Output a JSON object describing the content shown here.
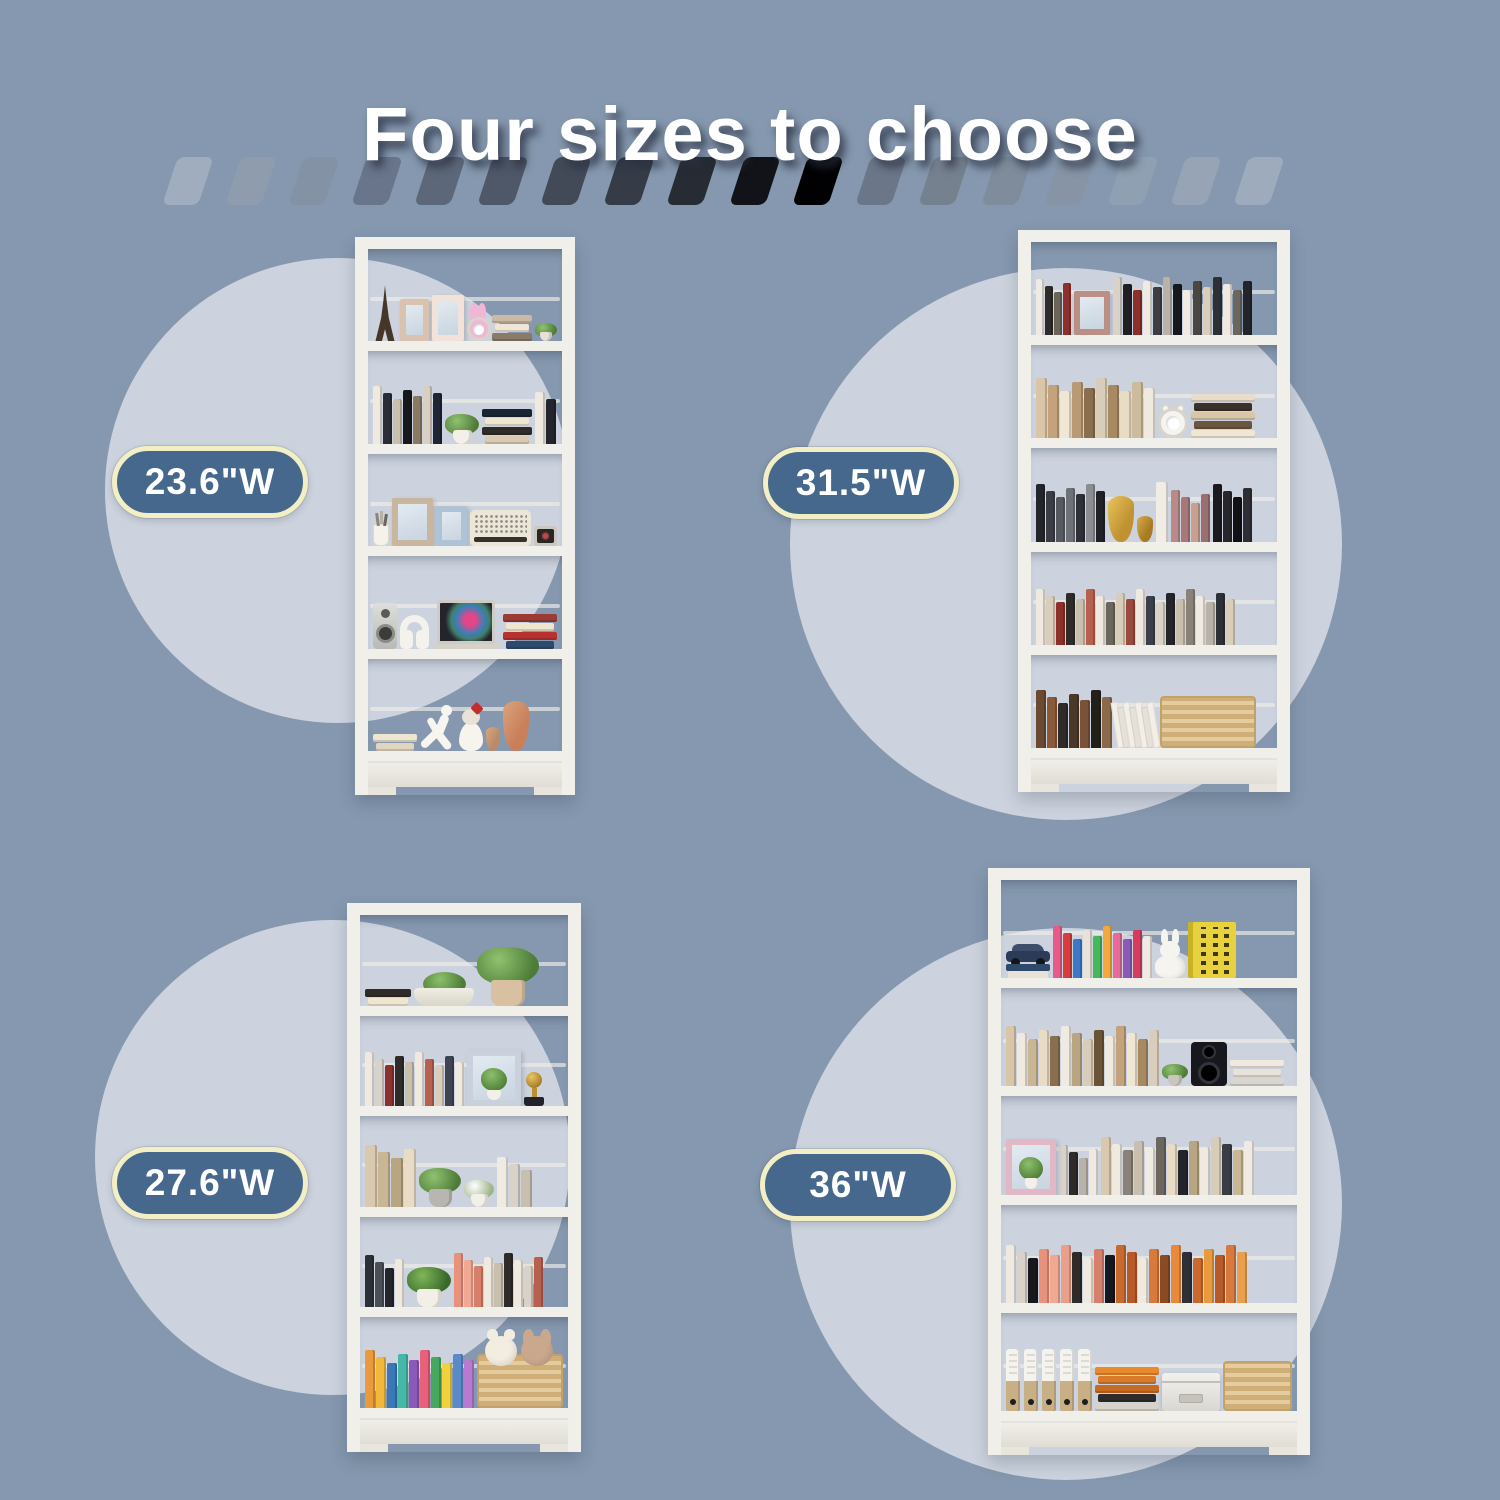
{
  "title": "Four sizes to choose",
  "palette": {
    "background": "#8598AF",
    "circle": "#CCD3DE",
    "pill_fill": "#45688C",
    "pill_border": "#F2EFC4",
    "pill_text": "#FFFFFF",
    "title_color": "#FFFFFF",
    "frame": "#F1EFE9"
  },
  "dashes": [
    "#9fadbe",
    "#8e9cae",
    "#8392a5",
    "#68758a",
    "#5c6879",
    "#4e5868",
    "#424a58",
    "#353c48",
    "#262b34",
    "#111318",
    "#010103",
    "#6b7789",
    "#75818f",
    "#7e8c9b",
    "#8694a6",
    "#8ea0b2",
    "#96a4b6",
    "#9dabbd"
  ],
  "sizes": [
    {
      "id": "tl",
      "label": "23.6\"W"
    },
    {
      "id": "tr",
      "label": "31.5\"W"
    },
    {
      "id": "bl",
      "label": "27.6\"W"
    },
    {
      "id": "br",
      "label": "36\"W"
    }
  ],
  "bookcases": {
    "tl": {
      "shelves": [
        [
          {
            "t": "eiffel",
            "w": 26,
            "h": 56
          },
          {
            "t": "frame",
            "c": "#d9c2ae",
            "w": 30,
            "h": 42
          },
          {
            "t": "frame",
            "c": "#f2e3da",
            "w": 34,
            "h": 46
          },
          {
            "t": "clock",
            "c": "#f0b6d4",
            "kind": "bunny",
            "w": 24,
            "h": 38
          },
          {
            "t": "stack",
            "c": [
              "#c9b9a5",
              "#efe6d8",
              "#8a7a68"
            ],
            "w": 40
          },
          {
            "t": "plant",
            "w": 22,
            "pot": "#e9e1d7"
          }
        ],
        [
          {
            "t": "books",
            "c": [
              "#efe9df",
              "#2a2d35",
              "#c9bfae",
              "#16181d",
              "#8a7a63",
              "#d8cfc2",
              "#1f2535"
            ],
            "h": 58,
            "w": 9
          },
          {
            "t": "plant",
            "w": 34,
            "pot": "#f4f0e9"
          },
          {
            "t": "stack",
            "c": [
              "#1b2433",
              "#efe6d0",
              "#2e2b28",
              "#d9c9b2"
            ],
            "w": 50
          },
          {
            "t": "books",
            "c": [
              "#efe9df",
              "#23252d"
            ],
            "h": 52,
            "w": 10
          }
        ],
        [
          {
            "t": "cup",
            "w": 16,
            "h": 22
          },
          {
            "t": "frame",
            "c": "#c9b6a0",
            "w": 42,
            "h": 48
          },
          {
            "t": "frame",
            "c": "#aec3d6",
            "w": 32,
            "h": 40
          },
          {
            "t": "radio",
            "w": 64,
            "h": 36
          },
          {
            "t": "tv",
            "w": 24,
            "h": 20
          }
        ],
        [
          {
            "t": "speaker",
            "w": 30,
            "h": 46
          },
          {
            "t": "headphones",
            "w": 36,
            "h": 34
          },
          {
            "t": "laptop",
            "w": 52,
            "h": 38
          },
          {
            "t": "stack",
            "c": [
              "#9b3b34",
              "#efe6d0",
              "#b8312e",
              "#2e4a6b"
            ],
            "w": 54
          }
        ],
        [
          {
            "t": "stack",
            "c": [
              "#efe6d0",
              "#e0d5c0"
            ],
            "w": 44
          },
          {
            "t": "runner",
            "w": 36,
            "h": 46
          },
          {
            "t": "girl",
            "w": 24,
            "h": 48
          },
          {
            "t": "vase",
            "c": "#b98a6a",
            "w": 14,
            "h": 24
          },
          {
            "t": "vase",
            "c": "#c97f5a",
            "w": 26,
            "h": 50
          }
        ]
      ]
    },
    "tr": {
      "shelves": [
        [
          {
            "t": "books",
            "c": [
              "#efeae2",
              "#2e2b28",
              "#6b6459",
              "#8d2f2a"
            ],
            "h": 56,
            "w": 8
          },
          {
            "t": "frame",
            "c": "#b98f86",
            "w": 36,
            "h": 44
          },
          {
            "t": "books",
            "c": [
              "#d8d2c8",
              "#1f1f24",
              "#8d2f2a",
              "#efeae2",
              "#3e3c44",
              "#b8b2a8",
              "#16181d",
              "#efeae2",
              "#4a4642",
              "#d9cdbb",
              "#2e3037",
              "#efe9df",
              "#6b665e",
              "#23252b"
            ],
            "h": 58,
            "w": 9
          }
        ],
        [
          {
            "t": "books",
            "c": [
              "#d9c6a8",
              "#c3a27c",
              "#efe6d4",
              "#b99a74",
              "#8a6f4e",
              "#d8cdb8",
              "#a88a62",
              "#e8dcc4",
              "#cdbb9e",
              "#efe9df"
            ],
            "h": 60,
            "w": 11
          },
          {
            "t": "clock",
            "c": "#f6f4ef",
            "kind": "alarm",
            "w": 30,
            "h": 34
          },
          {
            "t": "stack",
            "c": [
              "#e8ddc8",
              "#3a3228",
              "#d9c6a8",
              "#6b5640",
              "#efe6d4"
            ],
            "w": 64
          }
        ],
        [
          {
            "t": "books",
            "c": [
              "#23252b",
              "#3a3d45",
              "#56595f",
              "#6e7178",
              "#2e3037",
              "#8a8d92",
              "#1f2126"
            ],
            "h": 58,
            "w": 9
          },
          {
            "t": "vase",
            "c": "#c09232",
            "c2": "#e8c45c",
            "w": 26,
            "h": 46
          },
          {
            "t": "vase",
            "c": "#a87b22",
            "c2": "#d8ac4a",
            "w": 16,
            "h": 26
          },
          {
            "t": "books",
            "c": [
              "#f1ece4"
            ],
            "h": 60,
            "w": 12
          },
          {
            "t": "books",
            "c": [
              "#b98a8a",
              "#a87878",
              "#c9a090",
              "#9b6f6f"
            ],
            "h": 52,
            "w": 9
          },
          {
            "t": "books",
            "c": [
              "#1b1b1f",
              "#26262c",
              "#111115",
              "#2e2e34"
            ],
            "h": 58,
            "w": 9
          }
        ],
        [
          {
            "t": "books",
            "c": [
              "#efe9df",
              "#d9cdbb",
              "#8d2f2a",
              "#2e2b28",
              "#c9bfae",
              "#b8604f",
              "#efe9df",
              "#6b665e",
              "#d8cdb8",
              "#9b4a3e",
              "#efe9df",
              "#3a3f4a",
              "#d8d2c8",
              "#23252b",
              "#c9bfae",
              "#8a8278",
              "#efeae2",
              "#b8b2a8",
              "#2e3037",
              "#d9cdbb"
            ],
            "h": 56,
            "w": 9
          }
        ],
        [
          {
            "t": "books",
            "c": [
              "#6b4a32",
              "#8a5a3a",
              "#2e2b28",
              "#4a3828",
              "#7a5238",
              "#23201c",
              "#8a6a4a"
            ],
            "h": 58,
            "w": 10
          },
          {
            "t": "mags",
            "w": 40,
            "h": 44
          },
          {
            "t": "basket",
            "w": 92,
            "h": 48
          }
        ]
      ]
    },
    "bl": {
      "shelves": [
        [
          {
            "t": "stack",
            "c": [
              "#2e2b28",
              "#efe6d0"
            ],
            "w": 46
          },
          {
            "t": "bowlplant",
            "w": 60
          },
          {
            "t": "plant",
            "w": 62,
            "pot": "#d9c0a0"
          }
        ],
        [
          {
            "t": "books",
            "c": [
              "#efe9df",
              "#d8d2c8",
              "#8d2f2a",
              "#2e2b28",
              "#c9bfae",
              "#efe9df",
              "#b8604f",
              "#d9cdbb",
              "#3e4452",
              "#efe9df"
            ],
            "h": 54,
            "w": 9
          },
          {
            "t": "framePlant",
            "c": "#c9d2dc",
            "w": 54,
            "h": 56
          },
          {
            "t": "trophy",
            "w": 22,
            "h": 44
          }
        ],
        [
          {
            "t": "books",
            "c": [
              "#d9c9ae",
              "#c9b694",
              "#b8a582",
              "#e8dcc6"
            ],
            "h": 62,
            "w": 12
          },
          {
            "t": "plant",
            "w": 42,
            "pot": "#b9b6b0"
          },
          {
            "t": "flowers",
            "w": 30
          },
          {
            "t": "books",
            "c": [
              "#efeae2",
              "#d8d2c8",
              "#c9bfae"
            ],
            "h": 50,
            "w": 11
          }
        ],
        [
          {
            "t": "books",
            "c": [
              "#2e3037",
              "#4a4e56",
              "#23252b",
              "#efe9df"
            ],
            "h": 52,
            "w": 9
          },
          {
            "t": "fern",
            "w": 44
          },
          {
            "t": "books",
            "c": [
              "#e8927e",
              "#f1a893",
              "#d87f6b",
              "#efe9df",
              "#c9bfae",
              "#2e2b28",
              "#efe9df",
              "#d8d2c8",
              "#b8604f"
            ],
            "h": 54,
            "w": 9
          }
        ],
        [
          {
            "t": "books",
            "c": [
              "#e89a3c",
              "#f1b83c",
              "#3c78b8",
              "#45b8a8",
              "#8a5ab8",
              "#e8607a",
              "#45a85c",
              "#f1d23c",
              "#5a8ac9",
              "#b87ad0"
            ],
            "h": 58,
            "w": 10
          },
          {
            "t": "basket",
            "w": 96,
            "h": 50,
            "p": [
              "#f3ede1",
              "#c9a88e"
            ]
          }
        ]
      ]
    },
    "br": {
      "shelves": [
        [
          {
            "t": "car",
            "w": 44,
            "h": 34
          },
          {
            "t": "books",
            "c": [
              "#e85a8a",
              "#d83c3c",
              "#3c78c8",
              "#e8e2d8",
              "#45b85c",
              "#f1a83c",
              "#e86a9a",
              "#8a5ab8",
              "#d83c5c",
              "#efe9df"
            ],
            "h": 52,
            "w": 9
          },
          {
            "t": "bunnyfig",
            "w": 30,
            "h": 46
          },
          {
            "t": "bigbook",
            "w": 48,
            "h": 56
          }
        ],
        [
          {
            "t": "books",
            "c": [
              "#d9c6a8",
              "#efe9df",
              "#c9b694",
              "#e8dcc6",
              "#8a6f4e",
              "#efeae2",
              "#b8a582",
              "#d8cdb8",
              "#6b5436",
              "#efe9df",
              "#c3a27c",
              "#efe6d4",
              "#a88a62",
              "#d9cdbb"
            ],
            "h": 60,
            "w": 10
          },
          {
            "t": "plant",
            "w": 26,
            "pot": "#c9c6bf"
          },
          {
            "t": "speakerblack",
            "w": 36,
            "h": 44
          },
          {
            "t": "stack",
            "c": [
              "#efe9df",
              "#e8e2d8",
              "#d8d6d0"
            ],
            "w": 54
          }
        ],
        [
          {
            "t": "framePlant",
            "c": "#e3b8c6",
            "w": 50,
            "h": 56
          },
          {
            "t": "books",
            "c": [
              "#d8d2c8",
              "#2e2b28",
              "#b8b2a8",
              "#efe9df"
            ],
            "h": 50,
            "w": 9
          },
          {
            "t": "books",
            "c": [
              "#d9c9ae",
              "#efe9df",
              "#8a8278",
              "#c9bfae",
              "#efeae2",
              "#6b665e",
              "#e8dcc6",
              "#23252b",
              "#b8a582",
              "#efe9df",
              "#d8cdb8",
              "#3a3d45",
              "#c9b694",
              "#efeae2"
            ],
            "h": 58,
            "w": 10
          }
        ],
        [
          {
            "t": "books",
            "c": [
              "#efe9df",
              "#d8d2c8",
              "#16181d",
              "#e8927e",
              "#f1a893",
              "#e8a08a",
              "#2e2b28",
              "#efe9df",
              "#d87f6b",
              "#16181d",
              "#c9692e",
              "#b85a28",
              "#efe9df",
              "#d87a3c",
              "#8a4a22",
              "#e8893c",
              "#2e3037",
              "#c9692e",
              "#e89a3c",
              "#b85a28",
              "#d87a3c",
              "#e8a04c"
            ],
            "h": 58,
            "w": 10
          }
        ],
        [
          {
            "t": "binders",
            "n": 5,
            "h": 62
          },
          {
            "t": "stack",
            "c": [
              "#e8892e",
              "#d87a28",
              "#c96a22",
              "#2e2b28",
              "#d8d2c8"
            ],
            "w": 64
          },
          {
            "t": "box",
            "w": 64,
            "h": 38
          },
          {
            "t": "basket",
            "w": 72,
            "h": 46
          }
        ]
      ]
    }
  }
}
